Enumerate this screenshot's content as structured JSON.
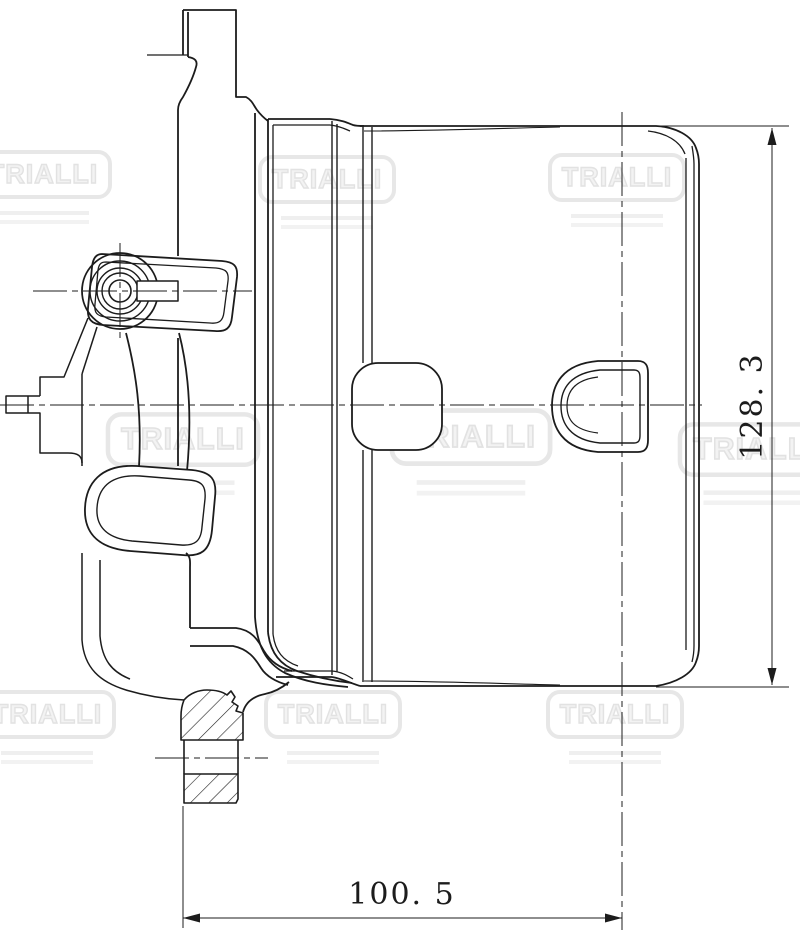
{
  "watermark": {
    "brand": "TRIALLI",
    "color": "#e7e7e7",
    "count": 9
  },
  "drawing": {
    "background": "#ffffff",
    "stroke_color": "#1c1c1c",
    "content": "side-view technical line drawing of an auto part (filter housing with mounting bracket, bushing boss and sectioned mounting flange)"
  },
  "dimensions": {
    "height": {
      "label": "128. 3",
      "value": 128.3,
      "orientation": "vertical"
    },
    "width": {
      "label": "100. 5",
      "value": 100.5,
      "orientation": "horizontal"
    }
  }
}
